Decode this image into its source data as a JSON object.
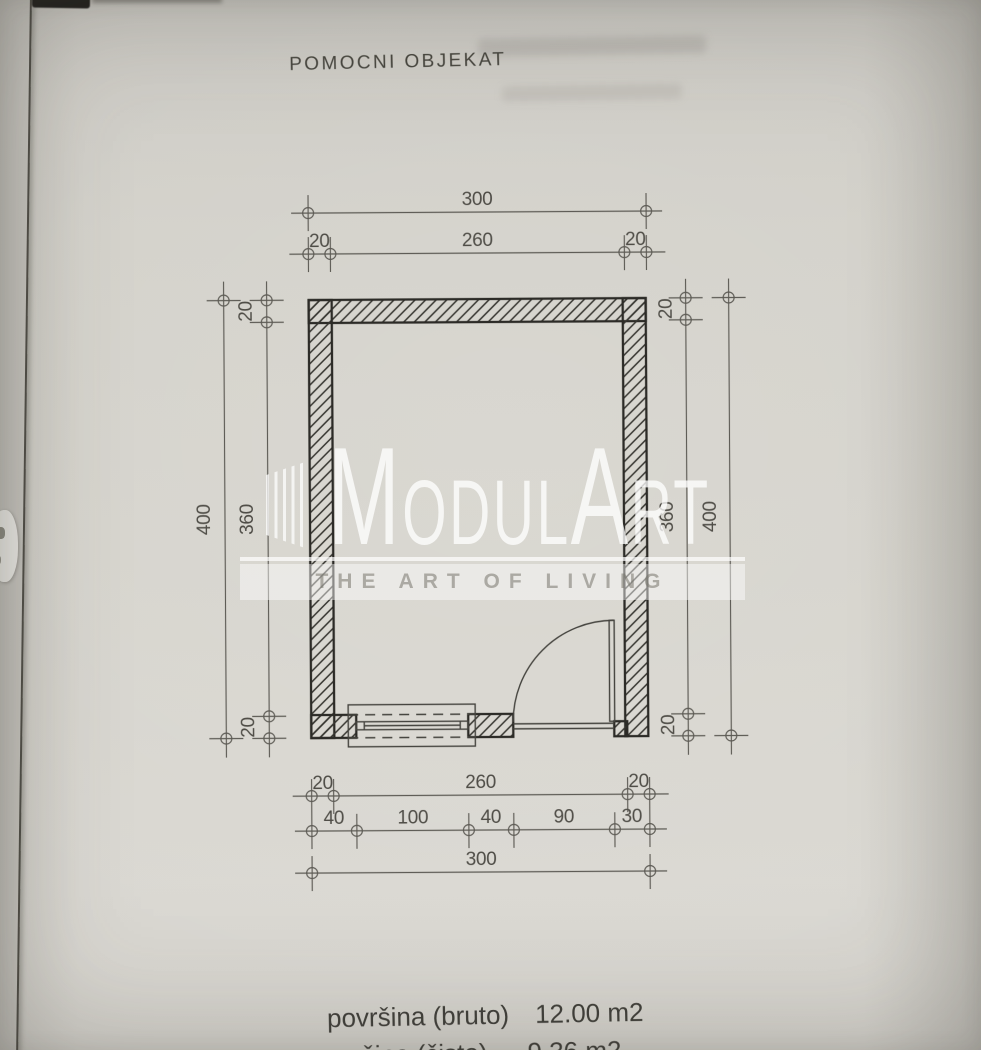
{
  "page": {
    "title": "POMOCNI OBJEKAT"
  },
  "watermark": {
    "part_m": "M",
    "part_odul": "ODUL",
    "part_a": "A",
    "part_rt": "RT",
    "tagline": "THE ART OF LIVING"
  },
  "plan": {
    "dims": {
      "top_total": "300",
      "top_wall_left": "20",
      "top_inner": "260",
      "top_wall_right": "20",
      "left_total": "400",
      "left_inner": "360",
      "left_wall_top": "20",
      "left_wall_bottom": "20",
      "right_total": "400",
      "right_inner": "360",
      "right_wall_top": "20",
      "right_wall_bottom": "20",
      "bottom_wall_left": "20",
      "bottom_inner": "260",
      "bottom_wall_right": "20",
      "bottom_seg_1": "40",
      "bottom_seg_2": "100",
      "bottom_seg_3": "40",
      "bottom_seg_4": "90",
      "bottom_seg_5": "30",
      "bottom_total": "300"
    }
  },
  "summary": {
    "area_gross_label": "površina (bruto)",
    "area_gross_value": "12.00 m2",
    "area_net_label": "površina (čisto)",
    "area_net_value": "9.36 m2"
  },
  "colors": {
    "paper": "#d6d4cd",
    "wall_line": "#2c2b27",
    "dim_line": "#5d5b55",
    "watermark": "#ffffff"
  }
}
